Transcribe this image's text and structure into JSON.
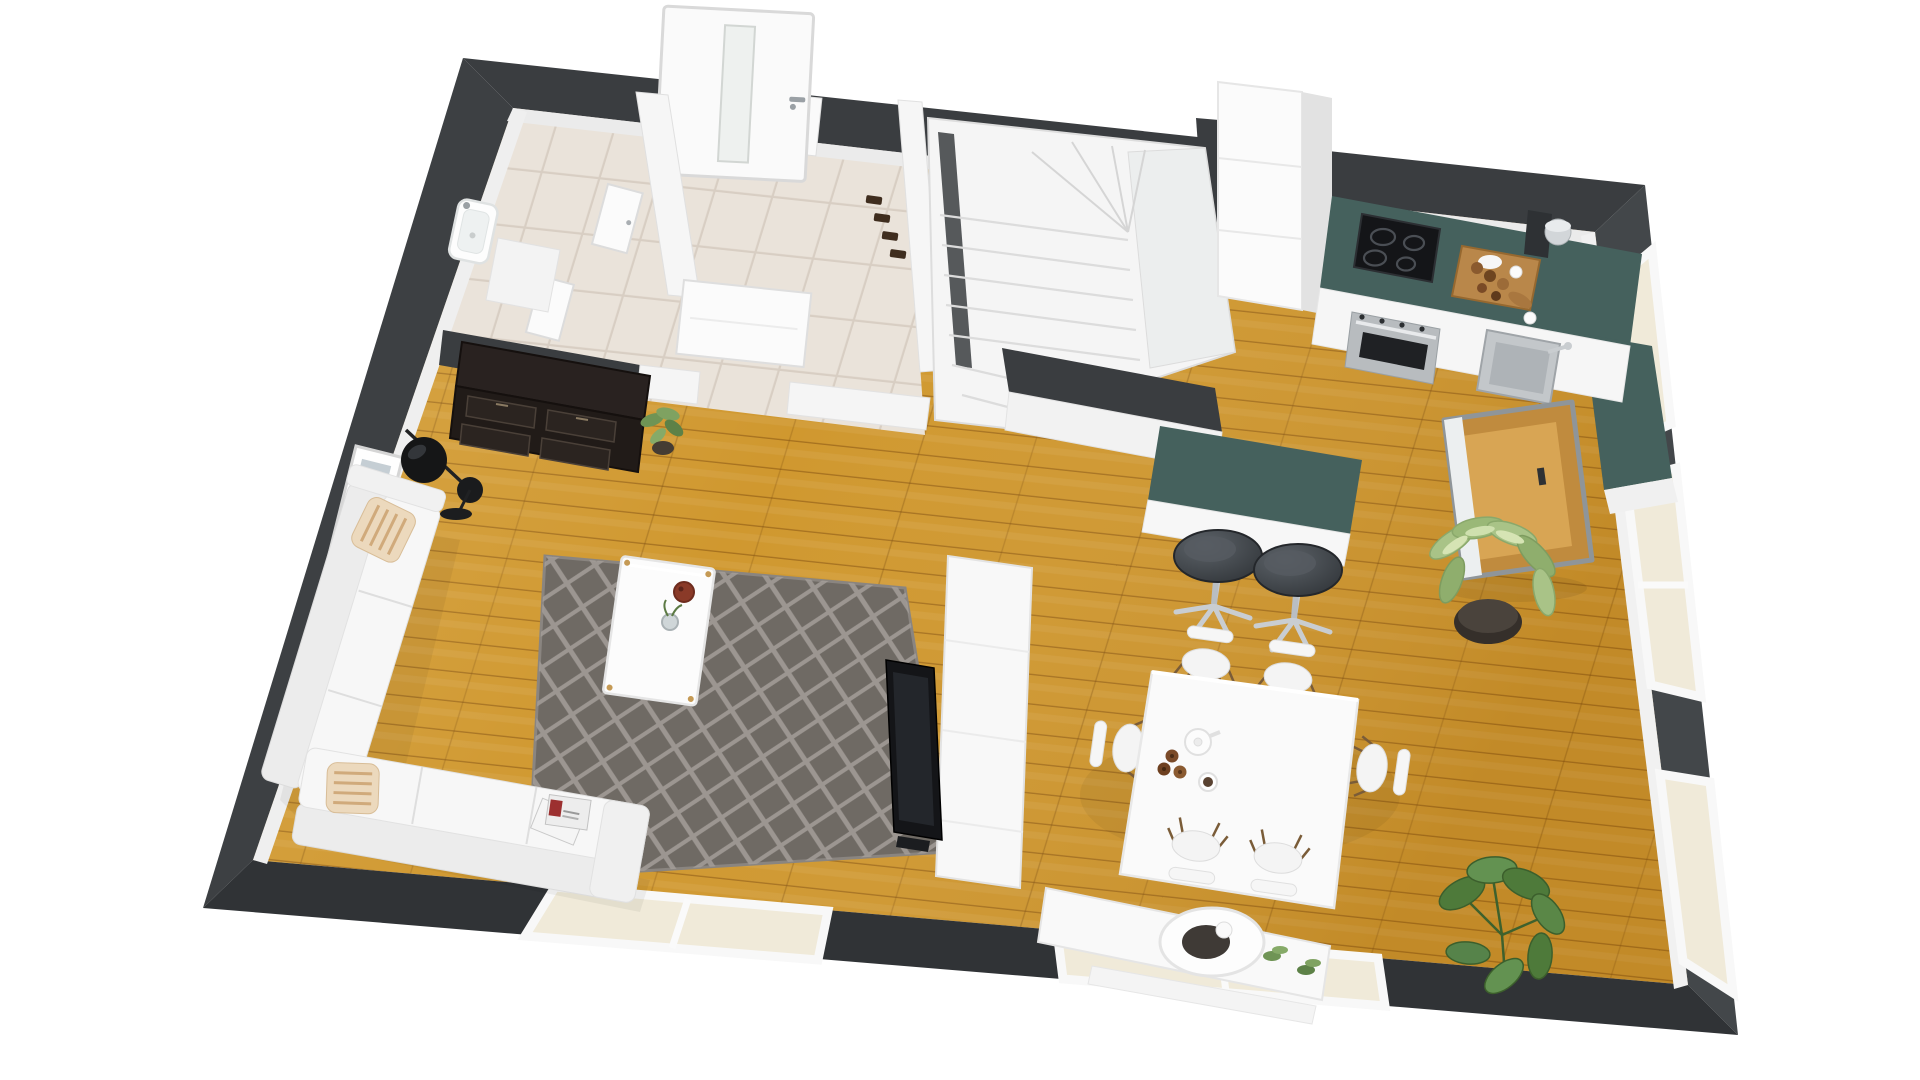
{
  "meta": {
    "title": "3D rendered floor plan — ground floor with open-plan living room, dining area, kitchen, hallway, bathroom and winder staircase",
    "type": "isometric-floor-plan-render",
    "view": "top-down perspective, plan rotated clockwise",
    "background_note": "white studio background, no visible text or UI chrome"
  },
  "palette": {
    "background": "#ffffff",
    "wall_dark": "#3a3d40",
    "wall_dark_light": "#474a4e",
    "interior_white": "#f7f7f7",
    "wall_white_face": "#ededed",
    "floor_wood": "#d0982f",
    "floor_wood_seam": "#8a5a10",
    "floor_tile": "#eae3da",
    "tile_grout": "#d8cec3",
    "counter_teal": "#45615d",
    "rug_base": "#6f6a64",
    "rug_line": "#a39e99",
    "appliance_black": "#141518",
    "stainless": "#b8bcbf",
    "stool_dark": "#383c41",
    "chrome": "#c7cbcf",
    "wood_furniture": "#b9874a",
    "dresser_dark": "#211b18",
    "plant_green": "#6f9455",
    "plant_light": "#a9c387",
    "pot_dark": "#352f2a",
    "pillow_base": "#ecd9bd",
    "pillow_stripe": "#c79a66",
    "glass": "#f0ead9"
  },
  "rooms": [
    {
      "name": "Bathroom",
      "floor": "beige tile",
      "items": [
        "wash basin",
        "white vanity cabinet",
        "open white door"
      ]
    },
    {
      "name": "Hallway",
      "floor": "beige tile",
      "items": [
        "open entrance door with glass slit",
        "coat hooks",
        "two open white interior doors"
      ]
    },
    {
      "name": "Staircase",
      "floor": "white",
      "items": [
        "winder stairs with quarter turn",
        "white stringer wall"
      ]
    },
    {
      "name": "Kitchen",
      "floor": "oak wood",
      "items": [
        "tall white cabinet columns",
        "teal L-shaped countertop",
        "induction cooktop",
        "stainless oven",
        "cutting board with pastries",
        "coffee maker",
        "stainless sink",
        "kitchen island with teal top",
        "two dark swivel bar stools"
      ]
    },
    {
      "name": "Dining area",
      "floor": "oak wood",
      "items": [
        "white rectangular table",
        "six white shell chairs",
        "teapot",
        "coffee cup",
        "donuts"
      ]
    },
    {
      "name": "Living room",
      "floor": "oak wood",
      "items": [
        "white L-shaped sectional sofa",
        "two striped pillows",
        "magazines",
        "gray diamond-pattern rug",
        "white coffee table with bowl and vase",
        "black double-shade floor lamp",
        "leaning picture frame",
        "dark sideboard dresser with plant",
        "TV on white room divider",
        "white media sideboard with round bowl",
        "potted dieffenbachia",
        "potted monstera"
      ]
    }
  ],
  "openings": {
    "entrance_door": "top wall, white leaf swung open outward",
    "right_wall_windows": 3,
    "bottom_wall_windows": 2,
    "open_window_sash": "swung into room near kitchen right counter"
  }
}
